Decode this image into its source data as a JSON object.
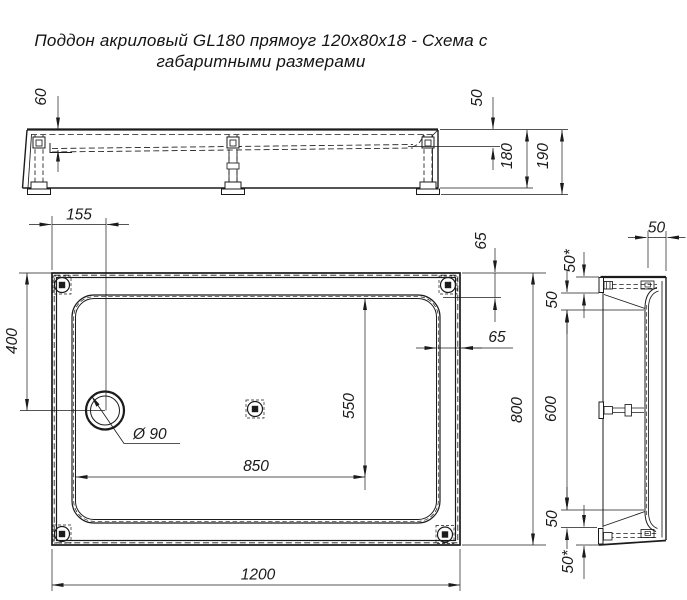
{
  "title": {
    "line1": "Поддон акриловый  GL180 прямоуг 120x80x18 - Схема с",
    "line2": "габаритными размерами"
  },
  "colors": {
    "line": "#1b1b1b",
    "background": "#ffffff"
  },
  "front_view": {
    "depth_left": "60",
    "depth_right": "50",
    "height_body": "180",
    "height_total": "190"
  },
  "plan_view": {
    "drain_offset_left": "155",
    "drain_offset_top": "400",
    "drain_diameter": "Ø 90",
    "rim_top": "65",
    "rim_right": "65",
    "floor_length": "850",
    "floor_width": "550",
    "overall_width": "800",
    "overall_length": "1200"
  },
  "side_view": {
    "top_wall": "50",
    "top_edge_to_foot": "50*",
    "top_foot_to_floor": "50",
    "feet_spacing": "600",
    "bottom_floor_to_foot": "50",
    "bottom_foot_to_edge": "50*"
  }
}
